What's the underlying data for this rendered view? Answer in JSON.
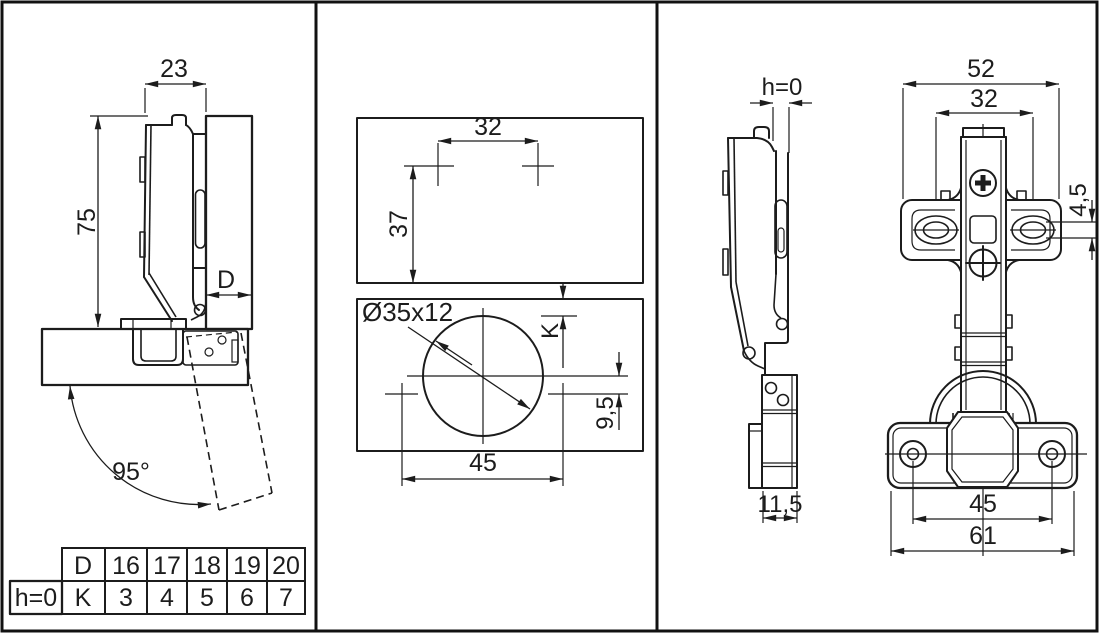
{
  "drawing": {
    "subject": "concealed cabinet hinge technical drawing",
    "line_color": "#1c1c1c",
    "bg_color": "#ffffff"
  },
  "side_section_view": {
    "dim_arm_width": "23",
    "dim_height": "75",
    "dim_overlay": "D",
    "dim_opening_angle": "95°"
  },
  "drilling_view": {
    "dim_plate_hole_spacing": "32",
    "dim_plate_offset": "37",
    "cup_bore_label": "Ø35x12",
    "dim_cup_edge_distance": "K",
    "dim_cup_screw_offset": "9,5",
    "dim_cup_screw_spacing": "45"
  },
  "side_view": {
    "dim_gap": "h=0",
    "dim_plate_depth": "11,5"
  },
  "front_view": {
    "dim_plate_width": "52",
    "dim_plate_hole_spacing": "32",
    "dim_slot_height": "4,5",
    "dim_cup_screw_spacing": "45",
    "dim_cup_flange_width": "61"
  },
  "table": {
    "corner_label": "h=0",
    "rows": [
      [
        "D",
        "16",
        "17",
        "18",
        "19",
        "20"
      ],
      [
        "K",
        "3",
        "4",
        "5",
        "6",
        "7"
      ]
    ]
  }
}
